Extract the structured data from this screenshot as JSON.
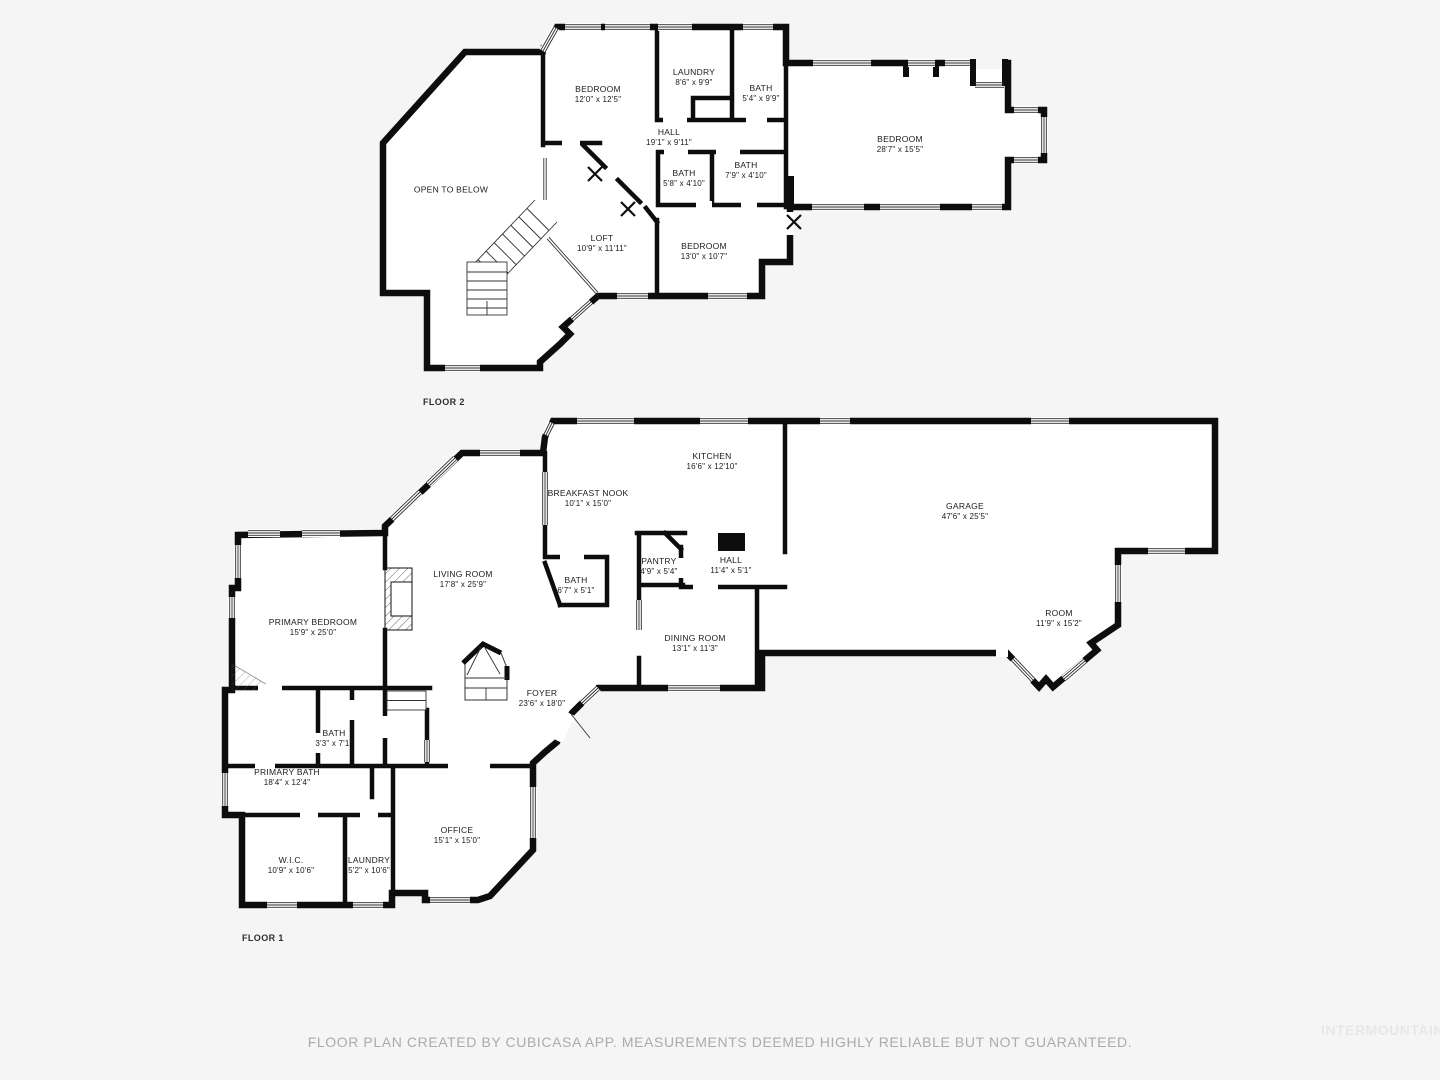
{
  "canvas": {
    "background": "#f5f5f5",
    "wall_color": "#0d0d0d",
    "disclaimer": "FLOOR PLAN CREATED BY CUBICASA APP. MEASUREMENTS DEEMED HIGHLY RELIABLE BUT NOT GUARANTEED.",
    "watermark": "INTERMOUNTAIN"
  },
  "floors": [
    {
      "label": "FLOOR 2",
      "rooms": [
        {
          "name": "BEDROOM",
          "dims": "12'0\" x 12'5\""
        },
        {
          "name": "LAUNDRY",
          "dims": "8'6\" x 9'9\""
        },
        {
          "name": "BATH",
          "dims": "5'4\" x 9'9\""
        },
        {
          "name": "HALL",
          "dims": "19'1\" x 9'11\""
        },
        {
          "name": "BATH",
          "dims": "5'8\" x 4'10\""
        },
        {
          "name": "BATH",
          "dims": "7'9\" x 4'10\""
        },
        {
          "name": "BEDROOM",
          "dims": "28'7\" x 15'5\""
        },
        {
          "name": "OPEN TO BELOW",
          "dims": ""
        },
        {
          "name": "LOFT",
          "dims": "10'9\" x 11'11\""
        },
        {
          "name": "BEDROOM",
          "dims": "13'0\" x 10'7\""
        }
      ]
    },
    {
      "label": "FLOOR 1",
      "rooms": [
        {
          "name": "KITCHEN",
          "dims": "16'6\" x 12'10\""
        },
        {
          "name": "BREAKFAST NOOK",
          "dims": "10'1\" x 15'0\""
        },
        {
          "name": "GARAGE",
          "dims": "47'6\" x 25'5\""
        },
        {
          "name": "PANTRY",
          "dims": "4'9\" x 5'4\""
        },
        {
          "name": "HALL",
          "dims": "11'4\" x 5'1\""
        },
        {
          "name": "BATH",
          "dims": "6'7\" x 5'1\""
        },
        {
          "name": "LIVING ROOM",
          "dims": "17'8\" x 25'9\""
        },
        {
          "name": "PRIMARY BEDROOM",
          "dims": "15'9\" x 25'0\""
        },
        {
          "name": "ROOM",
          "dims": "11'9\" x 15'2\""
        },
        {
          "name": "DINING ROOM",
          "dims": "13'1\" x 11'3\""
        },
        {
          "name": "FOYER",
          "dims": "23'6\" x 18'0\""
        },
        {
          "name": "BATH",
          "dims": "3'3\" x 7'1\""
        },
        {
          "name": "PRIMARY BATH",
          "dims": "18'4\" x 12'4\""
        },
        {
          "name": "W.I.C.",
          "dims": "10'9\" x 10'6\""
        },
        {
          "name": "LAUNDRY",
          "dims": "5'2\" x 10'6\""
        },
        {
          "name": "OFFICE",
          "dims": "15'1\" x 15'0\""
        }
      ]
    }
  ]
}
